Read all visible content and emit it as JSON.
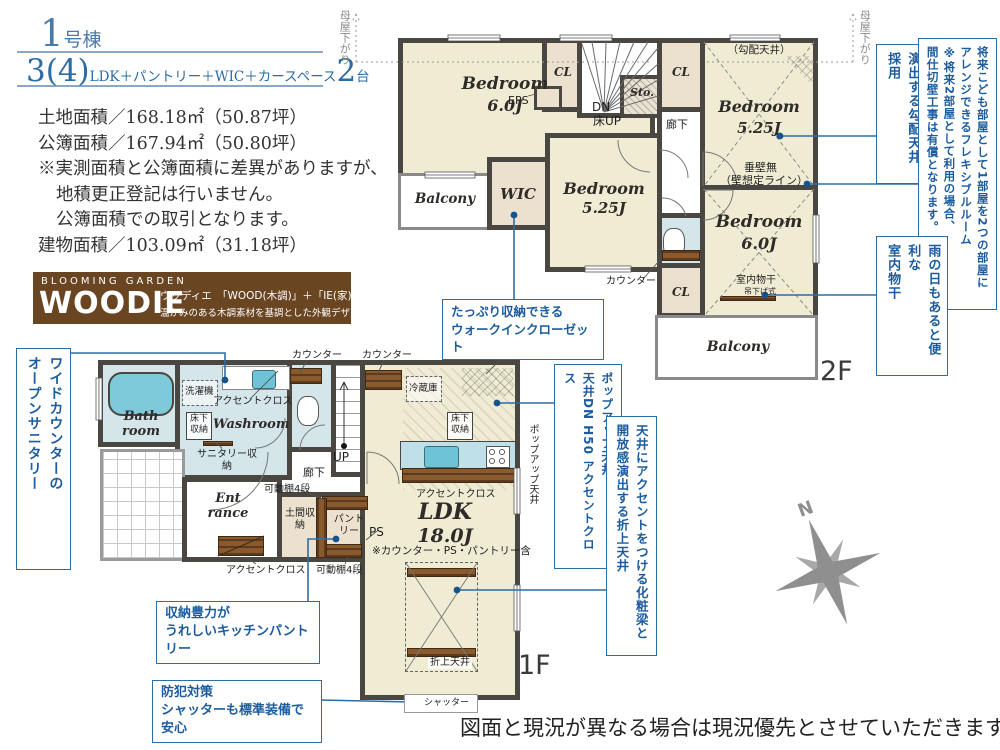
{
  "colors": {
    "accent_blue": "#2e6da4",
    "text_blue": "#1c5c9e",
    "wall": "#4a4743",
    "room_cream": "#f0ecd4",
    "closet_tan": "#ece1cf",
    "wet_blue": "#d4e6ea",
    "fixture_cyan": "#7ec9da",
    "wood_brown": "#7a4f28",
    "brand_brown": "#6a4522",
    "compass_gray": "#8f8f8f"
  },
  "header": {
    "unit_number": "1",
    "unit_suffix": "号棟",
    "plan_count": "3(4)",
    "plan_desc": "LDK＋パントリー＋WIC＋カースペース",
    "plan_cars": "2",
    "plan_cars_suffix": "台"
  },
  "site_info": {
    "lines": [
      "土地面積／168.18㎡（50.87坪）",
      "公簿面積／167.94㎡（50.80坪）",
      "※実測面積と公簿面積に差異がありますが、",
      "地積更正登記は行いません。",
      "公簿面積での取引となります。",
      "建物面積／103.09㎡（31.18坪）"
    ]
  },
  "brand": {
    "series": "BLOOMING GARDEN",
    "name": "WOODIE",
    "reading": "ウッディエ",
    "formula": "「WOOD(木調)」＋「IE(家)」",
    "tagline": "温かみのある木調素材を基調とした外観デザイン"
  },
  "floor2": {
    "label": "2F",
    "moyasagari": "母屋下がり",
    "bedroom_nw": {
      "name": "Bedroom",
      "size": "6.0J"
    },
    "bedroom_mid": {
      "name": "Bedroom",
      "size": "5.25J"
    },
    "bedroom_ne": {
      "name": "Bedroom",
      "size": "5.25J",
      "note": "（勾配天井）"
    },
    "bedroom_se": {
      "name": "Bedroom",
      "size": "6.0J"
    },
    "balcony_w": "Balcony",
    "balcony_s": "Balcony",
    "wic": "WIC",
    "cl_a": "CL",
    "cl_b": "CL",
    "cl_c": "CL",
    "eps": "EPS",
    "sto": "Sto.",
    "dn": "DN",
    "floor_up": "床UP",
    "hallway": "廊下",
    "counter": "カウンター",
    "tarekabe": "垂壁無",
    "tarekabe2": "（壁想定ライン）",
    "monohoshi": "室内物干",
    "monohoshi2": "吊下げ式"
  },
  "floor1": {
    "label": "1F",
    "bath": "Bath room",
    "washroom": "Washroom",
    "washer": "洗濯機",
    "accent_cloth_wash": "アクセントクロス",
    "underfloor_wash": "床下収納",
    "sanitary_storage": "サニタリー収納",
    "counter_a": "カウンター",
    "counter_b": "カウンター",
    "hallway": "廊下",
    "up": "UP",
    "entrance": "Ent rance",
    "shelf_a": "可動棚4段",
    "shelf_b": "可動棚4段",
    "doma": "土間収納",
    "pantry": "パントリー",
    "accent_cloth_ent": "アクセントクロス",
    "ps": "PS",
    "fridge": "冷蔵庫",
    "ceiling_dn": "天井DN",
    "underfloor_kitchen": "床下収納",
    "popup_ceiling": "ポップアップ天井",
    "accent_cloth_ldk": "アクセントクロス",
    "ldk": {
      "name": "LDK",
      "size": "18.0J",
      "note": "※カウンター・PS・パントリー含"
    },
    "oriage": "折上天井",
    "shutter": "シャッター"
  },
  "callouts": {
    "open_sanitary": [
      "ワイドカウンターの",
      "オープンサニタリー"
    ],
    "wic": [
      "たっぷり収納できる",
      "ウォークインクローゼット"
    ],
    "sloped_ceiling": [
      "開放感を",
      "演出する勾配天井採用"
    ],
    "flexible_room": [
      "将来こども部屋として1部屋を2つの部屋に",
      "アレンジできるフレキシブルルーム",
      "※将来2部屋として利用の場合、",
      "間仕切壁工事は有償となります。"
    ],
    "indoor_drying": [
      "雨の日もあると便利な",
      "室内物干"
    ],
    "popup": [
      "ポップアップ天井",
      "天井DN H50 アクセントクロス"
    ],
    "beam": [
      "天井にアクセントをつける化粧梁と",
      "開放感演出する折上天井"
    ],
    "pantry": [
      "収納豊力が",
      "うれしいキッチンパントリー"
    ],
    "security": [
      "防犯対策",
      "シャッターも標準装備で安心"
    ]
  },
  "compass": {
    "north": "N"
  },
  "disclaimer": "図面と現況が異なる場合は現況優先とさせていただきます。"
}
